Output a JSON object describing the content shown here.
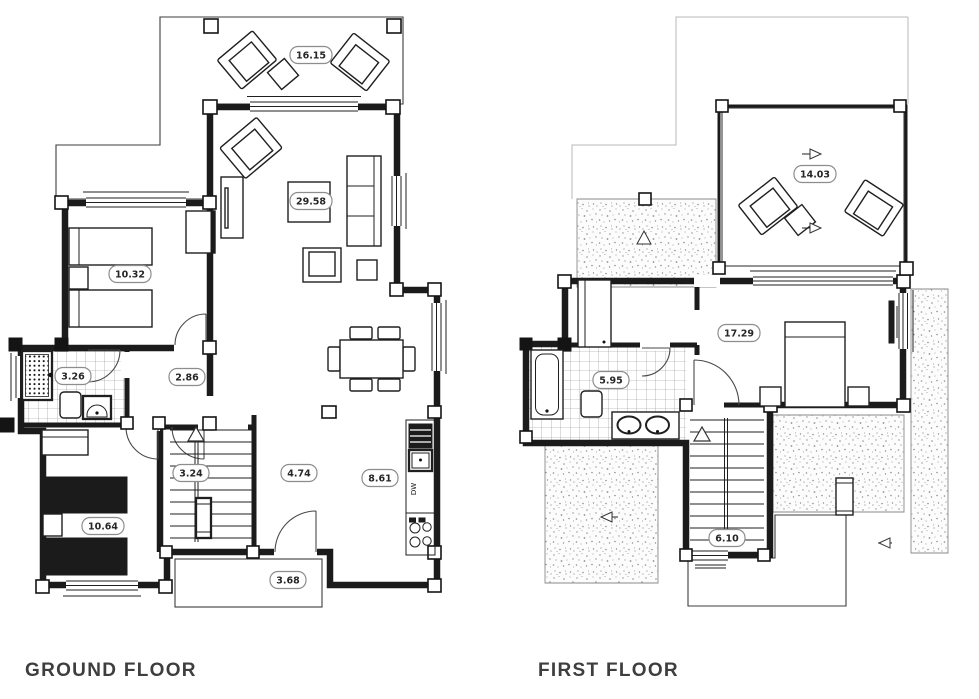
{
  "plans": [
    {
      "id": "ground-floor",
      "title": "GROUND FLOOR",
      "rooms": [
        {
          "name": "rear-deck",
          "area": "16.15"
        },
        {
          "name": "living-room",
          "area": "29.58"
        },
        {
          "name": "bedroom-1",
          "area": "10.32"
        },
        {
          "name": "bathroom",
          "area": "3.26"
        },
        {
          "name": "hall",
          "area": "2.86"
        },
        {
          "name": "stairs",
          "area": "3.24"
        },
        {
          "name": "corridor",
          "area": "4.74"
        },
        {
          "name": "kitchen",
          "area": "8.61"
        },
        {
          "name": "bedroom-2",
          "area": "10.64"
        },
        {
          "name": "entry-deck",
          "area": "3.68"
        }
      ]
    },
    {
      "id": "first-floor",
      "title": "FIRST FLOOR",
      "rooms": [
        {
          "name": "terrace",
          "area": "14.03"
        },
        {
          "name": "master-bedroom",
          "area": "17.29"
        },
        {
          "name": "bathroom",
          "area": "5.95"
        },
        {
          "name": "stairs",
          "area": "6.10"
        }
      ]
    }
  ],
  "annotations": {
    "dishwasher": "DW"
  },
  "colors": {
    "line": "#1b1b1b",
    "label_border": "#8d8d8d",
    "title_text": "#3e3e3e",
    "background": "#ffffff"
  }
}
